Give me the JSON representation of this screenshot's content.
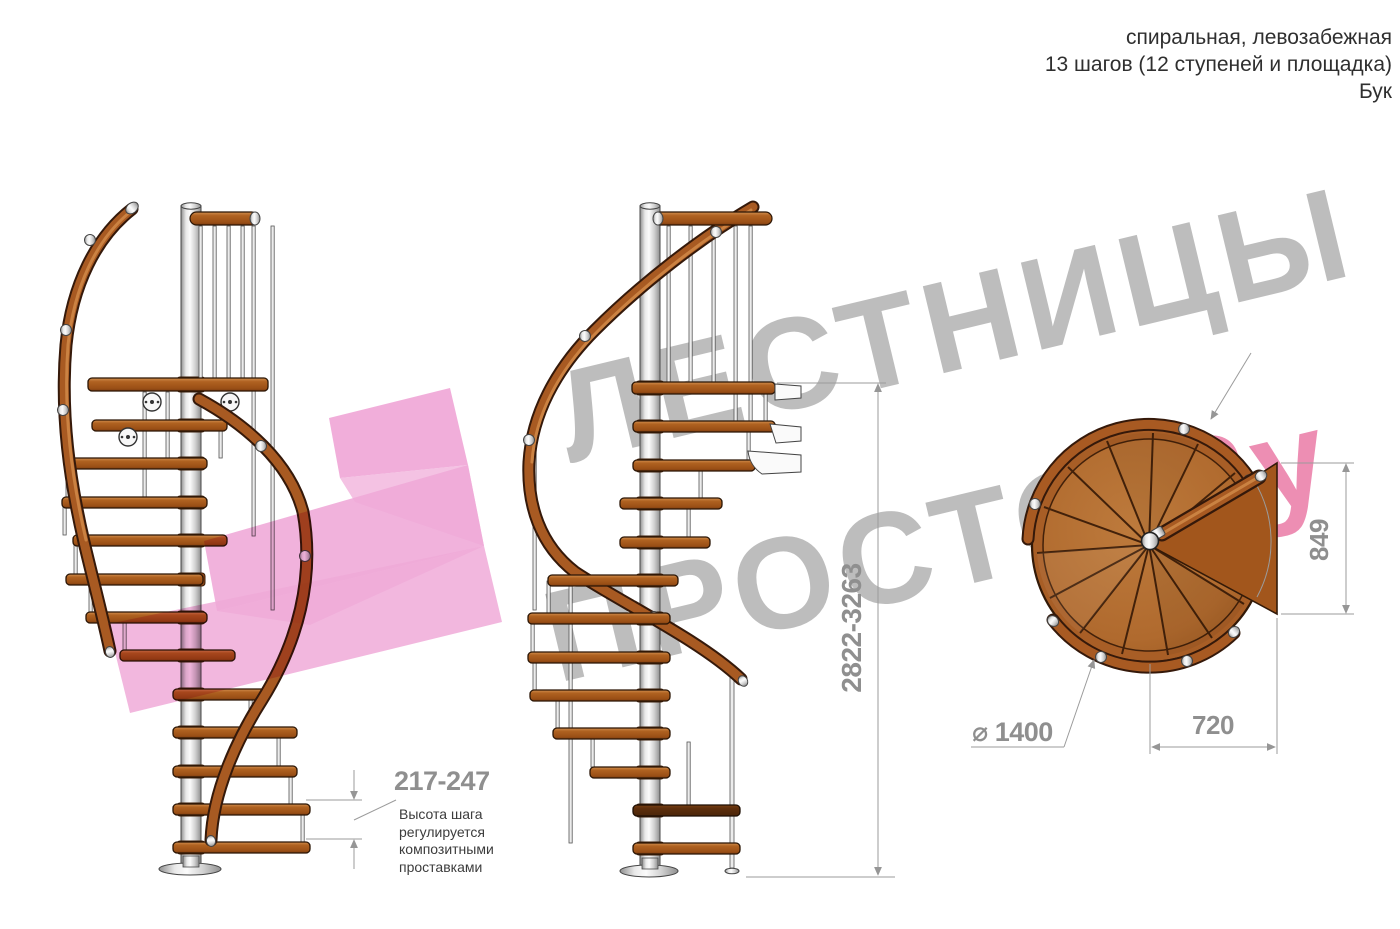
{
  "header": {
    "line1": "спиральная, левозабежная",
    "line2": "13 шагов (12 ступеней и площадка)",
    "line3": "Бук"
  },
  "watermark": {
    "word1": "ЛЕСТНИЦЫ",
    "word2": "ПРОСТО",
    "word3": ".Ру",
    "gray_color": "#808080",
    "pink_color": "#de3174",
    "logo_pink": "#f0aad8"
  },
  "annotations": {
    "step_height": {
      "value": "217-247",
      "note1": "Высота шага",
      "note2": "регулируется",
      "note3": "композитными",
      "note4": "проставками"
    },
    "total_height": {
      "value": "2822-3263"
    },
    "plan_height": {
      "value": "849"
    },
    "plan_offset": {
      "value": "720"
    },
    "diameter": {
      "value": "⌀ 1400"
    }
  },
  "colors": {
    "wood": "#a85f24",
    "handrail": "#a85a22",
    "metal": "#d9d9d9",
    "dimension_gray": "#8f8f8f"
  }
}
